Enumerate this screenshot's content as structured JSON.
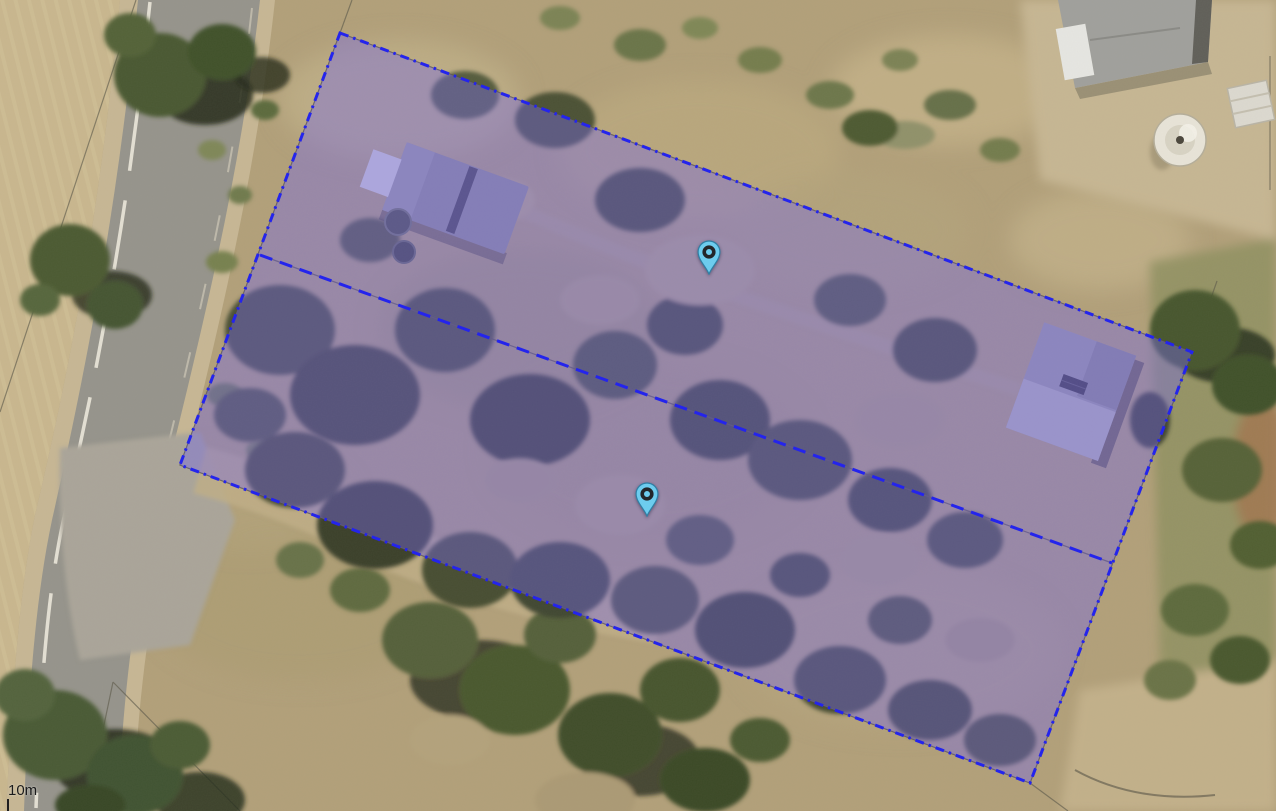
{
  "map": {
    "scale": {
      "label": "10m"
    },
    "overlay": {
      "border_color": "#2424ec",
      "fill_color": "rgba(118,106,228,0.42)",
      "outline_points": "340,33 1192,352 1030,783 180,465",
      "divider_points": "260,255 1112,563",
      "outline_dash": "9 5 2.5 5",
      "divider_dash": "13 8"
    },
    "markers": [
      {
        "name": "marker-1",
        "x": 709,
        "y": 275,
        "color": "#6dccee",
        "stroke": "#2f7fa4"
      },
      {
        "name": "marker-2",
        "x": 647,
        "y": 517,
        "color": "#6dccee",
        "stroke": "#2f7fa4"
      }
    ]
  }
}
